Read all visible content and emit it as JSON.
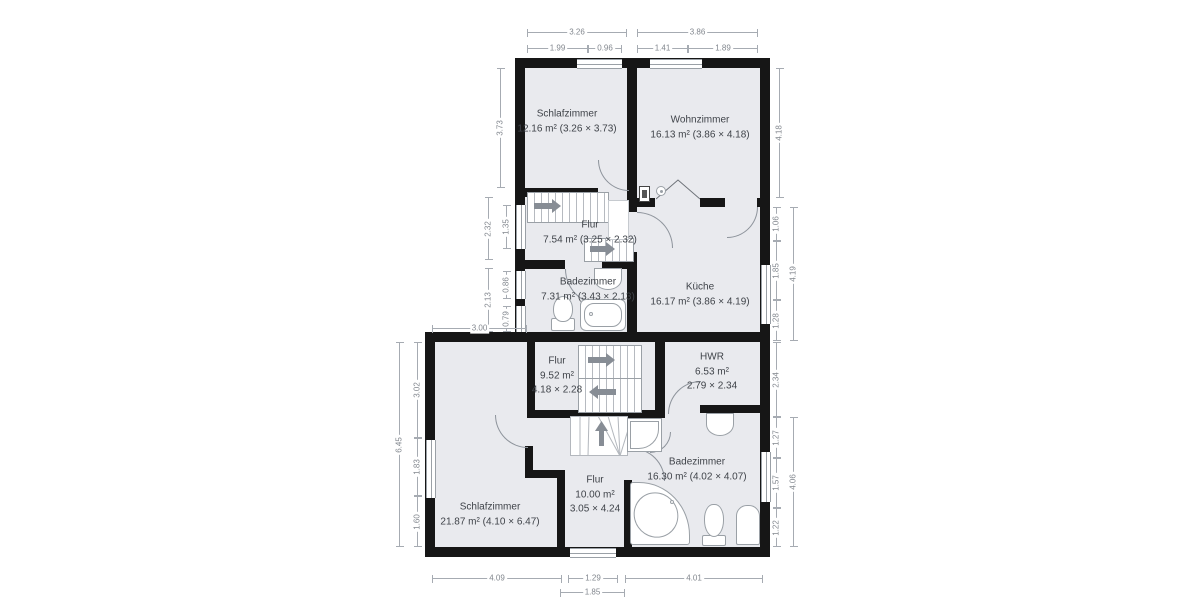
{
  "rooms": [
    {
      "lines": [
        "Schlafzimmer",
        "12.16 m² (3.26 × 3.73)"
      ]
    },
    {
      "lines": [
        "Wohnzimmer",
        "16.13 m² (3.86 × 4.18)"
      ]
    },
    {
      "lines": [
        "Flur",
        "7.54 m² (3.25 × 2.32)"
      ]
    },
    {
      "lines": [
        "Badezimmer",
        "7.31 m² (3.43 × 2.13)"
      ]
    },
    {
      "lines": [
        "Küche",
        "16.17 m² (3.86 × 4.19)"
      ]
    },
    {
      "lines": [
        "Flur",
        "9.52 m²",
        "4.18 × 2.28"
      ]
    },
    {
      "lines": [
        "HWR",
        "6.53 m²",
        "2.79 × 2.34"
      ]
    },
    {
      "lines": [
        "Badezimmer",
        "16.30 m² (4.02 × 4.07)"
      ]
    },
    {
      "lines": [
        "Schlafzimmer",
        "21.87 m² (4.10 × 6.47)"
      ]
    },
    {
      "lines": [
        "Flur",
        "10.00 m²",
        "3.05 × 4.24"
      ]
    }
  ],
  "dims": {
    "top": [
      "3.26",
      "3.86",
      "1.99",
      "0.96",
      "1.41",
      "1.89"
    ],
    "left_upper": [
      "3.73",
      "1.35",
      "2.32",
      "0.86",
      "2.13",
      "0.79",
      "3.00"
    ],
    "right_upper": [
      "4.18",
      "1.06",
      "1.85",
      "1.28",
      "4.19"
    ],
    "left_lower": [
      "3.02",
      "1.83",
      "1.60",
      "6.45"
    ],
    "right_lower": [
      "2.34",
      "1.27",
      "1.57",
      "1.22",
      "4.06"
    ],
    "bottom": [
      "4.09",
      "1.29",
      "4.01",
      "1.85"
    ]
  },
  "colors": {
    "wall": "#161616",
    "room_fill": "#e9eaee",
    "dimension": "#a6abb2",
    "label_text": "#3f4349",
    "fixture_stroke": "#9aa0a6",
    "arrow": "#878d95"
  },
  "icons": [
    "stair-direction-arrow-icon",
    "toilet-icon",
    "bathtub-icon",
    "corner-bathtub-icon",
    "sink-icon",
    "shower-icon",
    "boiler-icon",
    "electrical-panel-icon",
    "smoke-detector-icon",
    "wall-opening-chevron-icon",
    "window",
    "door-arc"
  ]
}
